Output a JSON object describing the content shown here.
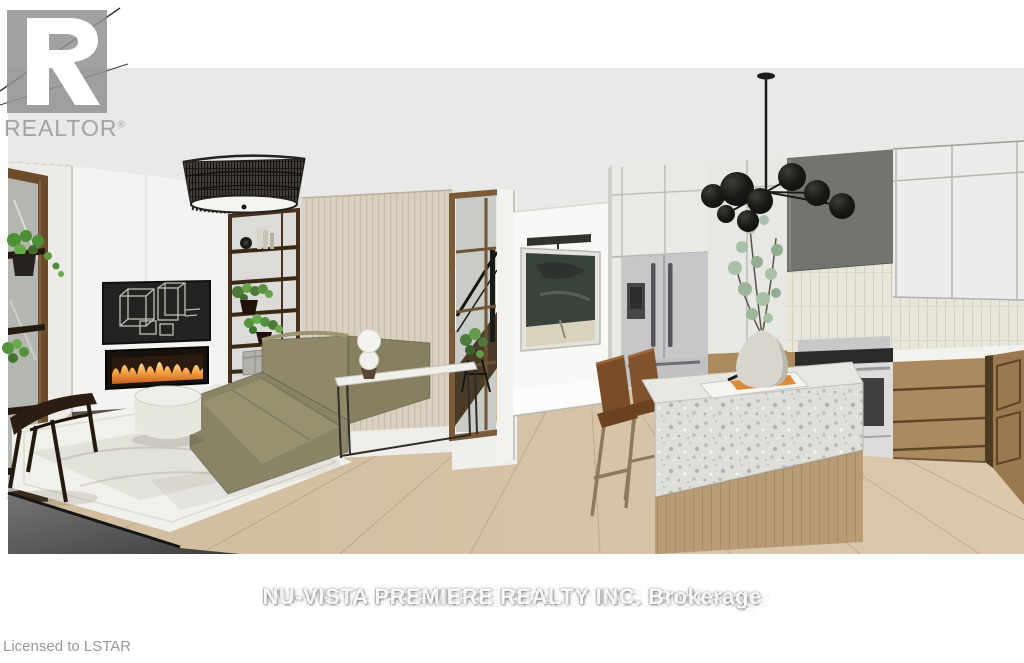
{
  "watermarks": {
    "realtor_label": "REALTOR",
    "registered_mark": "®",
    "brokerage_line": "NU-VISTA PREMIERE REALTY INC. Brokerage",
    "licensed_line": "Licensed to LSTAR"
  },
  "scene": {
    "kind": "3d-architectural-rendering",
    "rooms": "open-concept living room and kitchen",
    "objects": [
      "window-shelf-with-plants",
      "white-fireplace-wall",
      "abstract-line-art-tv",
      "linear-electric-fireplace",
      "wood-display-shelf",
      "beige-slat-wall",
      "rattan-drum-pendant",
      "olive-sectional-sofa",
      "round-white-ottoman",
      "console-table-with-sphere-lamp",
      "dark-lounge-chair",
      "ivory-area-rug",
      "glass-stair-partition",
      "framed-abstract-art",
      "picture-light",
      "panel-ready-cabinets",
      "french-door-refrigerator",
      "black-globe-chandelier",
      "grey-range-hood",
      "tile-backsplash",
      "stainless-range",
      "wood-base-cabinets",
      "terrazzo-waterfall-island",
      "leather-bar-stools",
      "eucalyptus-in-vase",
      "open-magazine",
      "light-oak-floor"
    ]
  },
  "colors": {
    "background": "#ffffff",
    "ceiling": "#e9eae7",
    "wall_white": "#f4f3f1",
    "wall_beige_slat": "#d9d0bf",
    "wood_frame_brown": "#6b4b2a",
    "sofa_olive": "#8d8769",
    "floor_oak": "#d5c2a6",
    "fire_orange": "#f0913a",
    "hood_grey": "#72756f",
    "cabinet_wood": "#a9895d",
    "island_terrazzo": "#dedfd8",
    "stool_leather": "#7d4e2a",
    "watermark_grey": "#a2a2a2"
  }
}
